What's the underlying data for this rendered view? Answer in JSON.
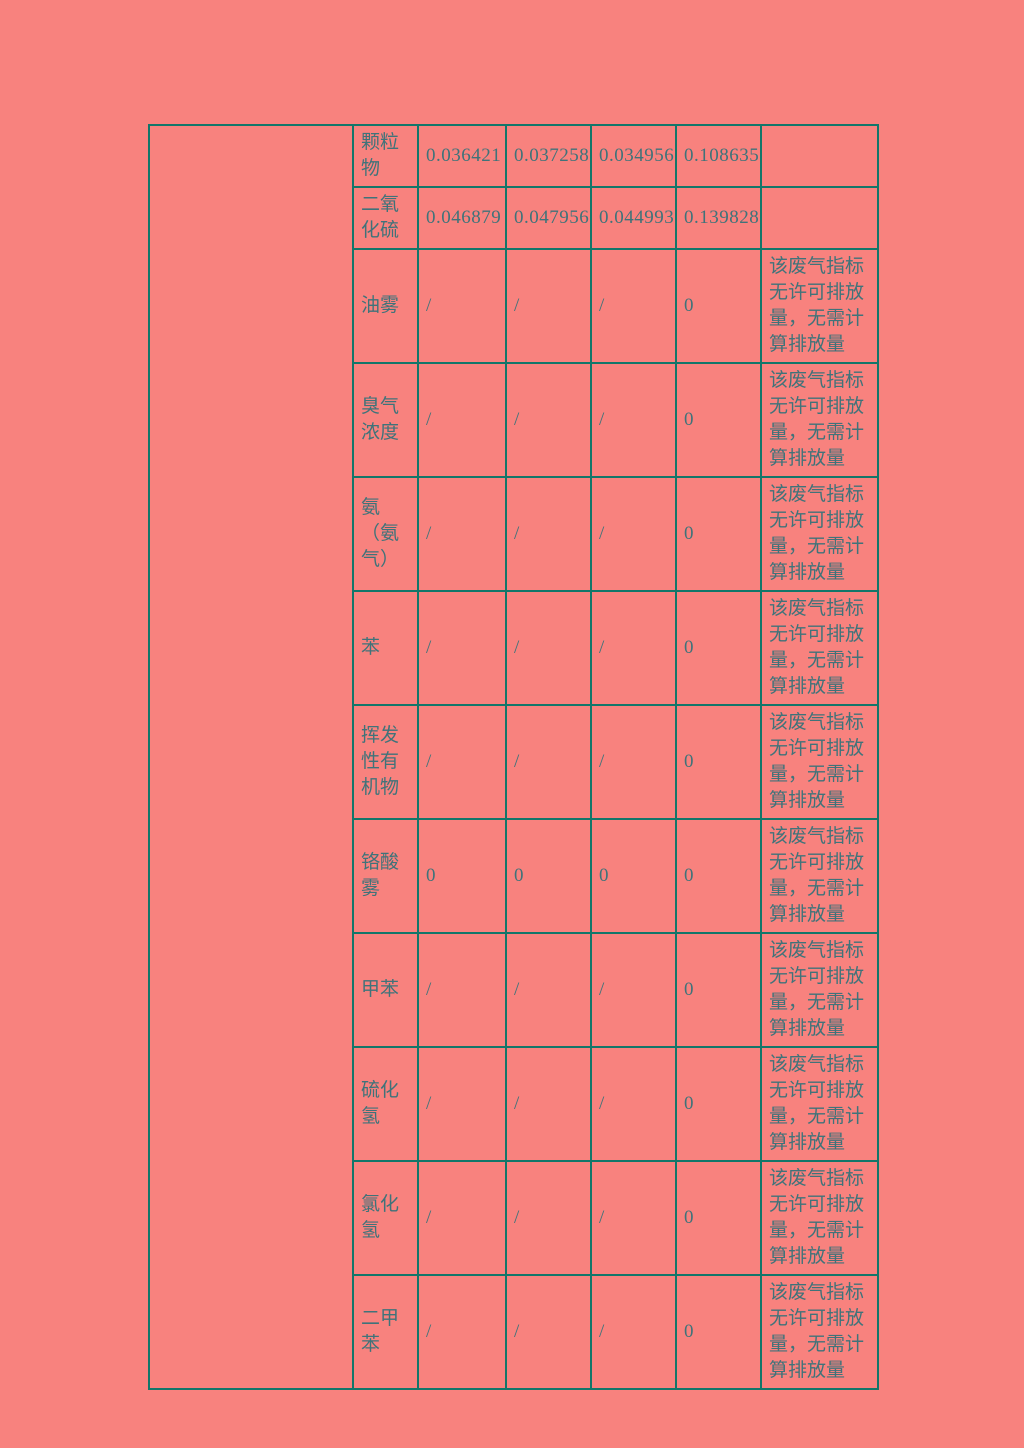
{
  "colors": {
    "page_background": "#f8827e",
    "table_border": "#12766a",
    "text": "#3f737a"
  },
  "table": {
    "merged_left_cell": "",
    "remark_text": "该废气指标无许可排放量，无需计算排放量",
    "rows": [
      {
        "name": "颗粒物",
        "values": [
          "0.036421",
          "0.037258",
          "0.034956",
          "0.108635"
        ],
        "remark": ""
      },
      {
        "name": "二氧化硫",
        "values": [
          "0.046879",
          "0.047956",
          "0.044993",
          "0.139828"
        ],
        "remark": ""
      },
      {
        "name": "油雾",
        "values": [
          "/",
          "/",
          "/",
          "0"
        ],
        "remark": "该废气指标无许可排放量，无需计算排放量"
      },
      {
        "name": "臭气浓度",
        "values": [
          "/",
          "/",
          "/",
          "0"
        ],
        "remark": "该废气指标无许可排放量，无需计算排放量"
      },
      {
        "name": "氨（氨气）",
        "values": [
          "/",
          "/",
          "/",
          "0"
        ],
        "remark": "该废气指标无许可排放量，无需计算排放量"
      },
      {
        "name": "苯",
        "values": [
          "/",
          "/",
          "/",
          "0"
        ],
        "remark": "该废气指标无许可排放量，无需计算排放量"
      },
      {
        "name": "挥发性有机物",
        "values": [
          "/",
          "/",
          "/",
          "0"
        ],
        "remark": "该废气指标无许可排放量，无需计算排放量"
      },
      {
        "name": "铬酸雾",
        "values": [
          "0",
          "0",
          "0",
          "0"
        ],
        "remark": "该废气指标无许可排放量，无需计算排放量"
      },
      {
        "name": "甲苯",
        "values": [
          "/",
          "/",
          "/",
          "0"
        ],
        "remark": "该废气指标无许可排放量，无需计算排放量"
      },
      {
        "name": "硫化氢",
        "values": [
          "/",
          "/",
          "/",
          "0"
        ],
        "remark": "该废气指标无许可排放量，无需计算排放量"
      },
      {
        "name": "氯化氢",
        "values": [
          "/",
          "/",
          "/",
          "0"
        ],
        "remark": "该废气指标无许可排放量，无需计算排放量"
      },
      {
        "name": "二甲苯",
        "values": [
          "/",
          "/",
          "/",
          "0"
        ],
        "remark": "该废气指标无许可排放量，无需计算排放量"
      }
    ]
  }
}
